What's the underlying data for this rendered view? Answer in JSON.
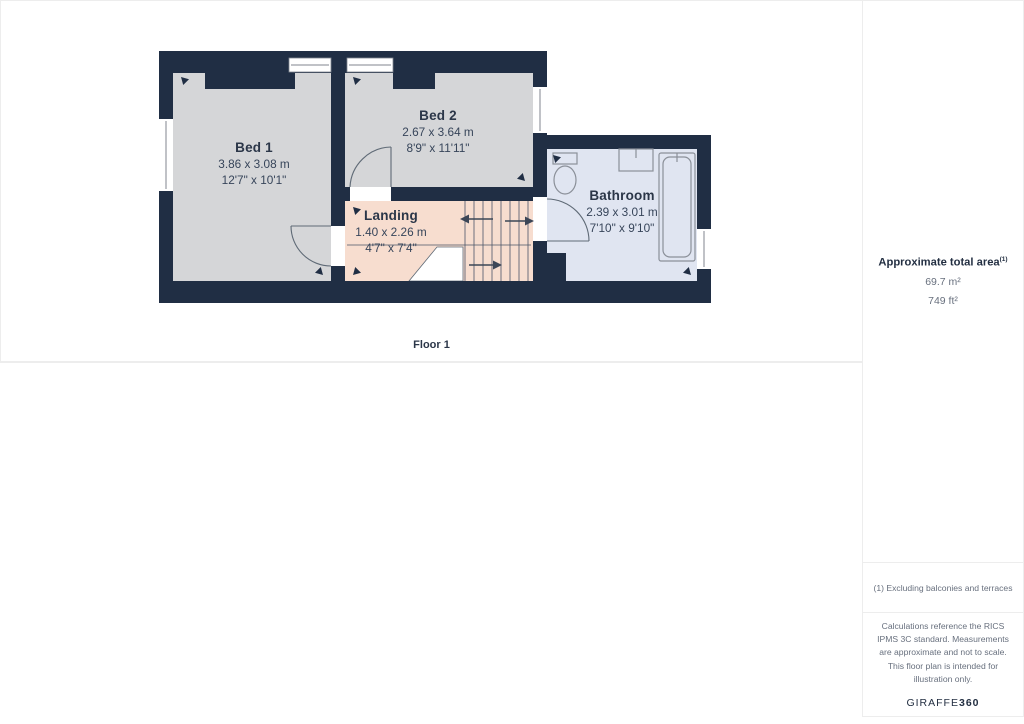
{
  "panels": {
    "ground_floor": {
      "floor_label": "Ground Floor",
      "rooms": [
        {
          "id": "lounge",
          "name": "Lounge",
          "metric": "2.85 x 3.09 m",
          "imperial": "9'4\" x 10'1\""
        },
        {
          "id": "dining_room",
          "name": "Dining Room",
          "metric": "3.27 x 3.62 m",
          "imperial": "10'8\" x 11'10\""
        },
        {
          "id": "kitchen",
          "name": "Kitchen",
          "metric": "2.32 x 3.97 m",
          "imperial": "7'7\" x 13'0\""
        },
        {
          "id": "hallway",
          "name": "Hallway",
          "metric": "0.88 x 3.70 m",
          "imperial": "2'10\" x 12'1\""
        }
      ]
    },
    "floor_1": {
      "floor_label": "Floor 1",
      "rooms": [
        {
          "id": "bed1",
          "name": "Bed 1",
          "metric": "3.86 x 3.08 m",
          "imperial": "12'7\" x 10'1\""
        },
        {
          "id": "bed2",
          "name": "Bed 2",
          "metric": "2.67 x 3.64 m",
          "imperial": "8'9\" x 11'11\""
        },
        {
          "id": "bathroom",
          "name": "Bathroom",
          "metric": "2.39 x 3.01 m",
          "imperial": "7'10\" x 9'10\""
        },
        {
          "id": "landing",
          "name": "Landing",
          "metric": "1.40 x 2.26 m",
          "imperial": "4'7\" x 7'4\""
        }
      ]
    }
  },
  "sidebar": {
    "total_area_title": "Approximate total area",
    "total_area_marker": "(1)",
    "total_area_metric": "69.7 m²",
    "total_area_imperial": "749 ft²",
    "footnote": "(1) Excluding balconies and terraces",
    "disclaimer": "Calculations reference the RICS IPMS 3C standard. Measurements are approximate and not to scale. This floor plan is intended for illustration only.",
    "brand_name": "GIRAFFE",
    "brand_suffix": "360"
  },
  "colors": {
    "wall": "#202e44",
    "room_gray": "#d5d6d8",
    "kitchen_cream": "#f2edda",
    "hallway_pink": "#f7ddcf",
    "bathroom_blue": "#e0e5f1",
    "label_text": "#2b3648"
  }
}
